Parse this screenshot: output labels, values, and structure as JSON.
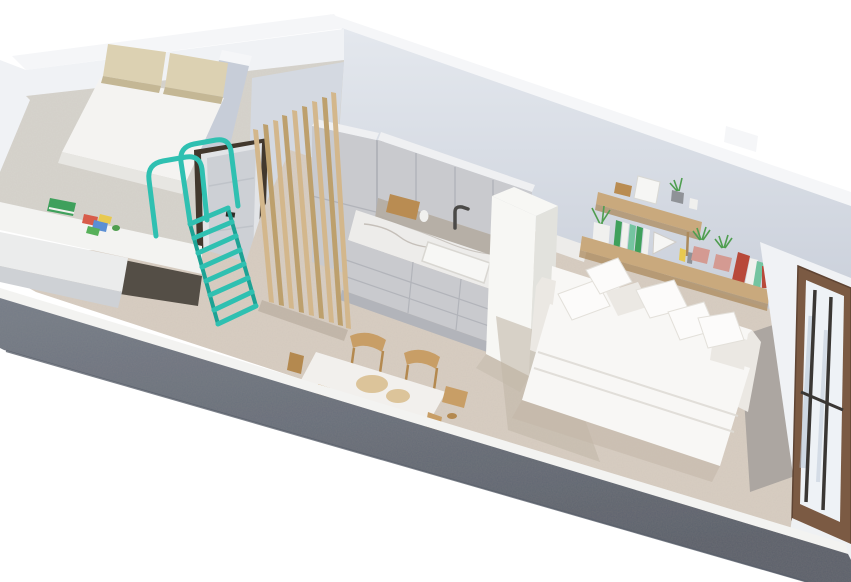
{
  "meta": {
    "title": "3D isometric cutaway floor-plan render of a studio apartment",
    "view": "axonometric from above, front wall cut open",
    "background": "#ffffff"
  },
  "scene": {
    "rooms": [
      {
        "name": "loft-bedroom",
        "label": "Loft bedroom",
        "furniture": [
          "double bed",
          "two beige pillows",
          "loft platform",
          "built-in desk",
          "green book",
          "colored papers"
        ]
      },
      {
        "name": "entry-hall",
        "label": "Entry hall",
        "furniture": [
          "entry door",
          "teal loft ladder with safety hoops",
          "wooden slat screen"
        ]
      },
      {
        "name": "kitchen",
        "label": "Kitchen",
        "furniture": [
          "tall cabinet column",
          "upper cabinets",
          "marble countertop",
          "sink",
          "faucet",
          "cutting board",
          "drawer base units",
          "white partition wall"
        ]
      },
      {
        "name": "dining-area",
        "label": "Dining area",
        "furniture": [
          "marble-top dining table",
          "wooden chairs",
          "serving bowls"
        ]
      },
      {
        "name": "living-area",
        "label": "Living / sleeping area",
        "furniture": [
          "white sofa bed",
          "throw pillows",
          "two-tier wooden wall shelf",
          "potted plants",
          "books",
          "picture frames",
          "bronze-framed window"
        ]
      }
    ]
  },
  "palette": {
    "bg": "#ffffff",
    "wallTop": "#f5f6f8",
    "wallFaceBright": "#f0f2f5",
    "wallFaceLight": "#e4e8ee",
    "wallFaceMid": "#d4d9e1",
    "wallFaceShade": "#c7cdd8",
    "cutTop": "#767d89",
    "cutBottom": "#5b616c",
    "floor": "#d8cec2",
    "floorShade": "#c2b7a8",
    "floorPath": "#a7a29d",
    "platformFloor": "#d7d4ce",
    "fascia": "#f3f3f1",
    "deskTop": "#ebecec",
    "deskEdge": "#ced1d5",
    "voidDark": "#544e46",
    "mattress": "#f4f3f1",
    "bedFrame": "#e7e6e2",
    "pillowBeige": "#dcd1b2",
    "pillowShade": "#c4b795",
    "doorFrameDark": "#42382d",
    "doorLeaf": "#e2e4e7",
    "doorLeafShade": "#cdd0d5",
    "handleDark": "#2f2b26",
    "teal": "#2fc0b1",
    "tealShade": "#1da294",
    "coral": "#ef8f85",
    "slatLight": "#d3b78c",
    "slatDark": "#bda06d",
    "cabinet": "#c9cace",
    "cabinetDark": "#b2b4ba",
    "cabinetTop": "#eff0f2",
    "nicheShadow": "#b6afa6",
    "counter": "#edecea",
    "marbleVein": "#b3aca4",
    "sinkWhite": "#f7f7f5",
    "faucet": "#4b4a48",
    "boardWood": "#b98c52",
    "partition": "#f7f7f4",
    "partitionShade": "#e2e2dd",
    "tableTop": "#f2f0ed",
    "tableEdge": "#dcd8d1",
    "chairWood": "#c89e66",
    "chairWoodDark": "#b4894f",
    "bowl": "#dcc49a",
    "sofa": "#f8f7f5",
    "sofaShade": "#ebe8e3",
    "pillowWhite": "#fcfbfa",
    "pillowLine": "#dfdcd6",
    "shelfWood": "#c9a97d",
    "shelfWoodDark": "#ab8a5c",
    "plantGreen": "#4f9e50",
    "potPink": "#d49a92",
    "potGray": "#8f9297",
    "bookGreen": "#3fa05c",
    "bookTeal": "#74c4a0",
    "bookRed": "#b8493a",
    "bookWhite": "#f1f1ee",
    "frameWhite": "#f6f6f4",
    "vaseWhite": "#f0f0ee",
    "paperRed": "#d85c4a",
    "paperBlue": "#5b8fd4",
    "paperYellow": "#e8c94f",
    "paperGreen": "#57b05a",
    "windowBronze": "#7b5a43",
    "windowBronzeDark": "#5f4433",
    "glassLight": "#eef2f6",
    "glassStreak": "#b5c3d4",
    "barDark": "#3a3734",
    "sill": "#eff1f3"
  }
}
